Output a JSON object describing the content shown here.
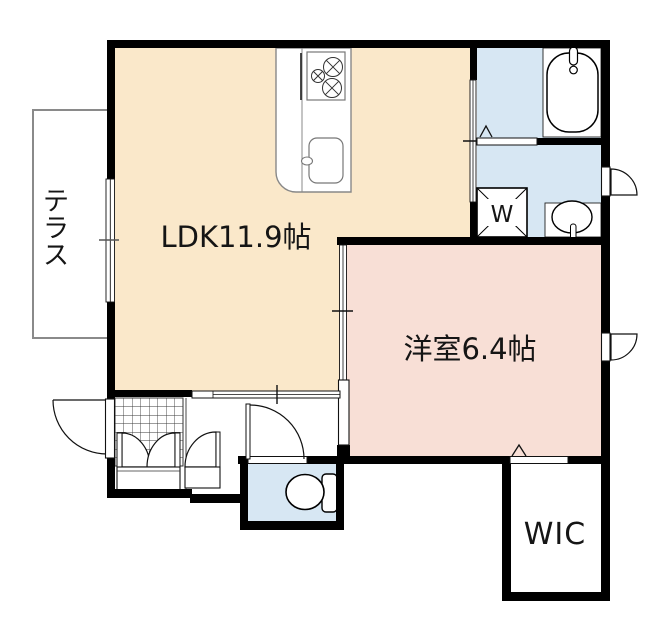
{
  "plan": {
    "labels": {
      "ldk": "LDK11.9帖",
      "western_room": "洋室6.4帖",
      "wic": "WIC",
      "washer": "W",
      "terrace": "テラス",
      "terrace_chars": [
        "テ",
        "ラ",
        "ス"
      ]
    },
    "colors": {
      "ldk_fill": "#FAE8CA",
      "western_fill": "#F8DFD6",
      "wet_fill": "#D7E7F3",
      "wall": "#000000",
      "outline": "#111111",
      "text": "#151515",
      "terrace_border": "#8A8A8A",
      "counter_line": "#888888"
    }
  }
}
